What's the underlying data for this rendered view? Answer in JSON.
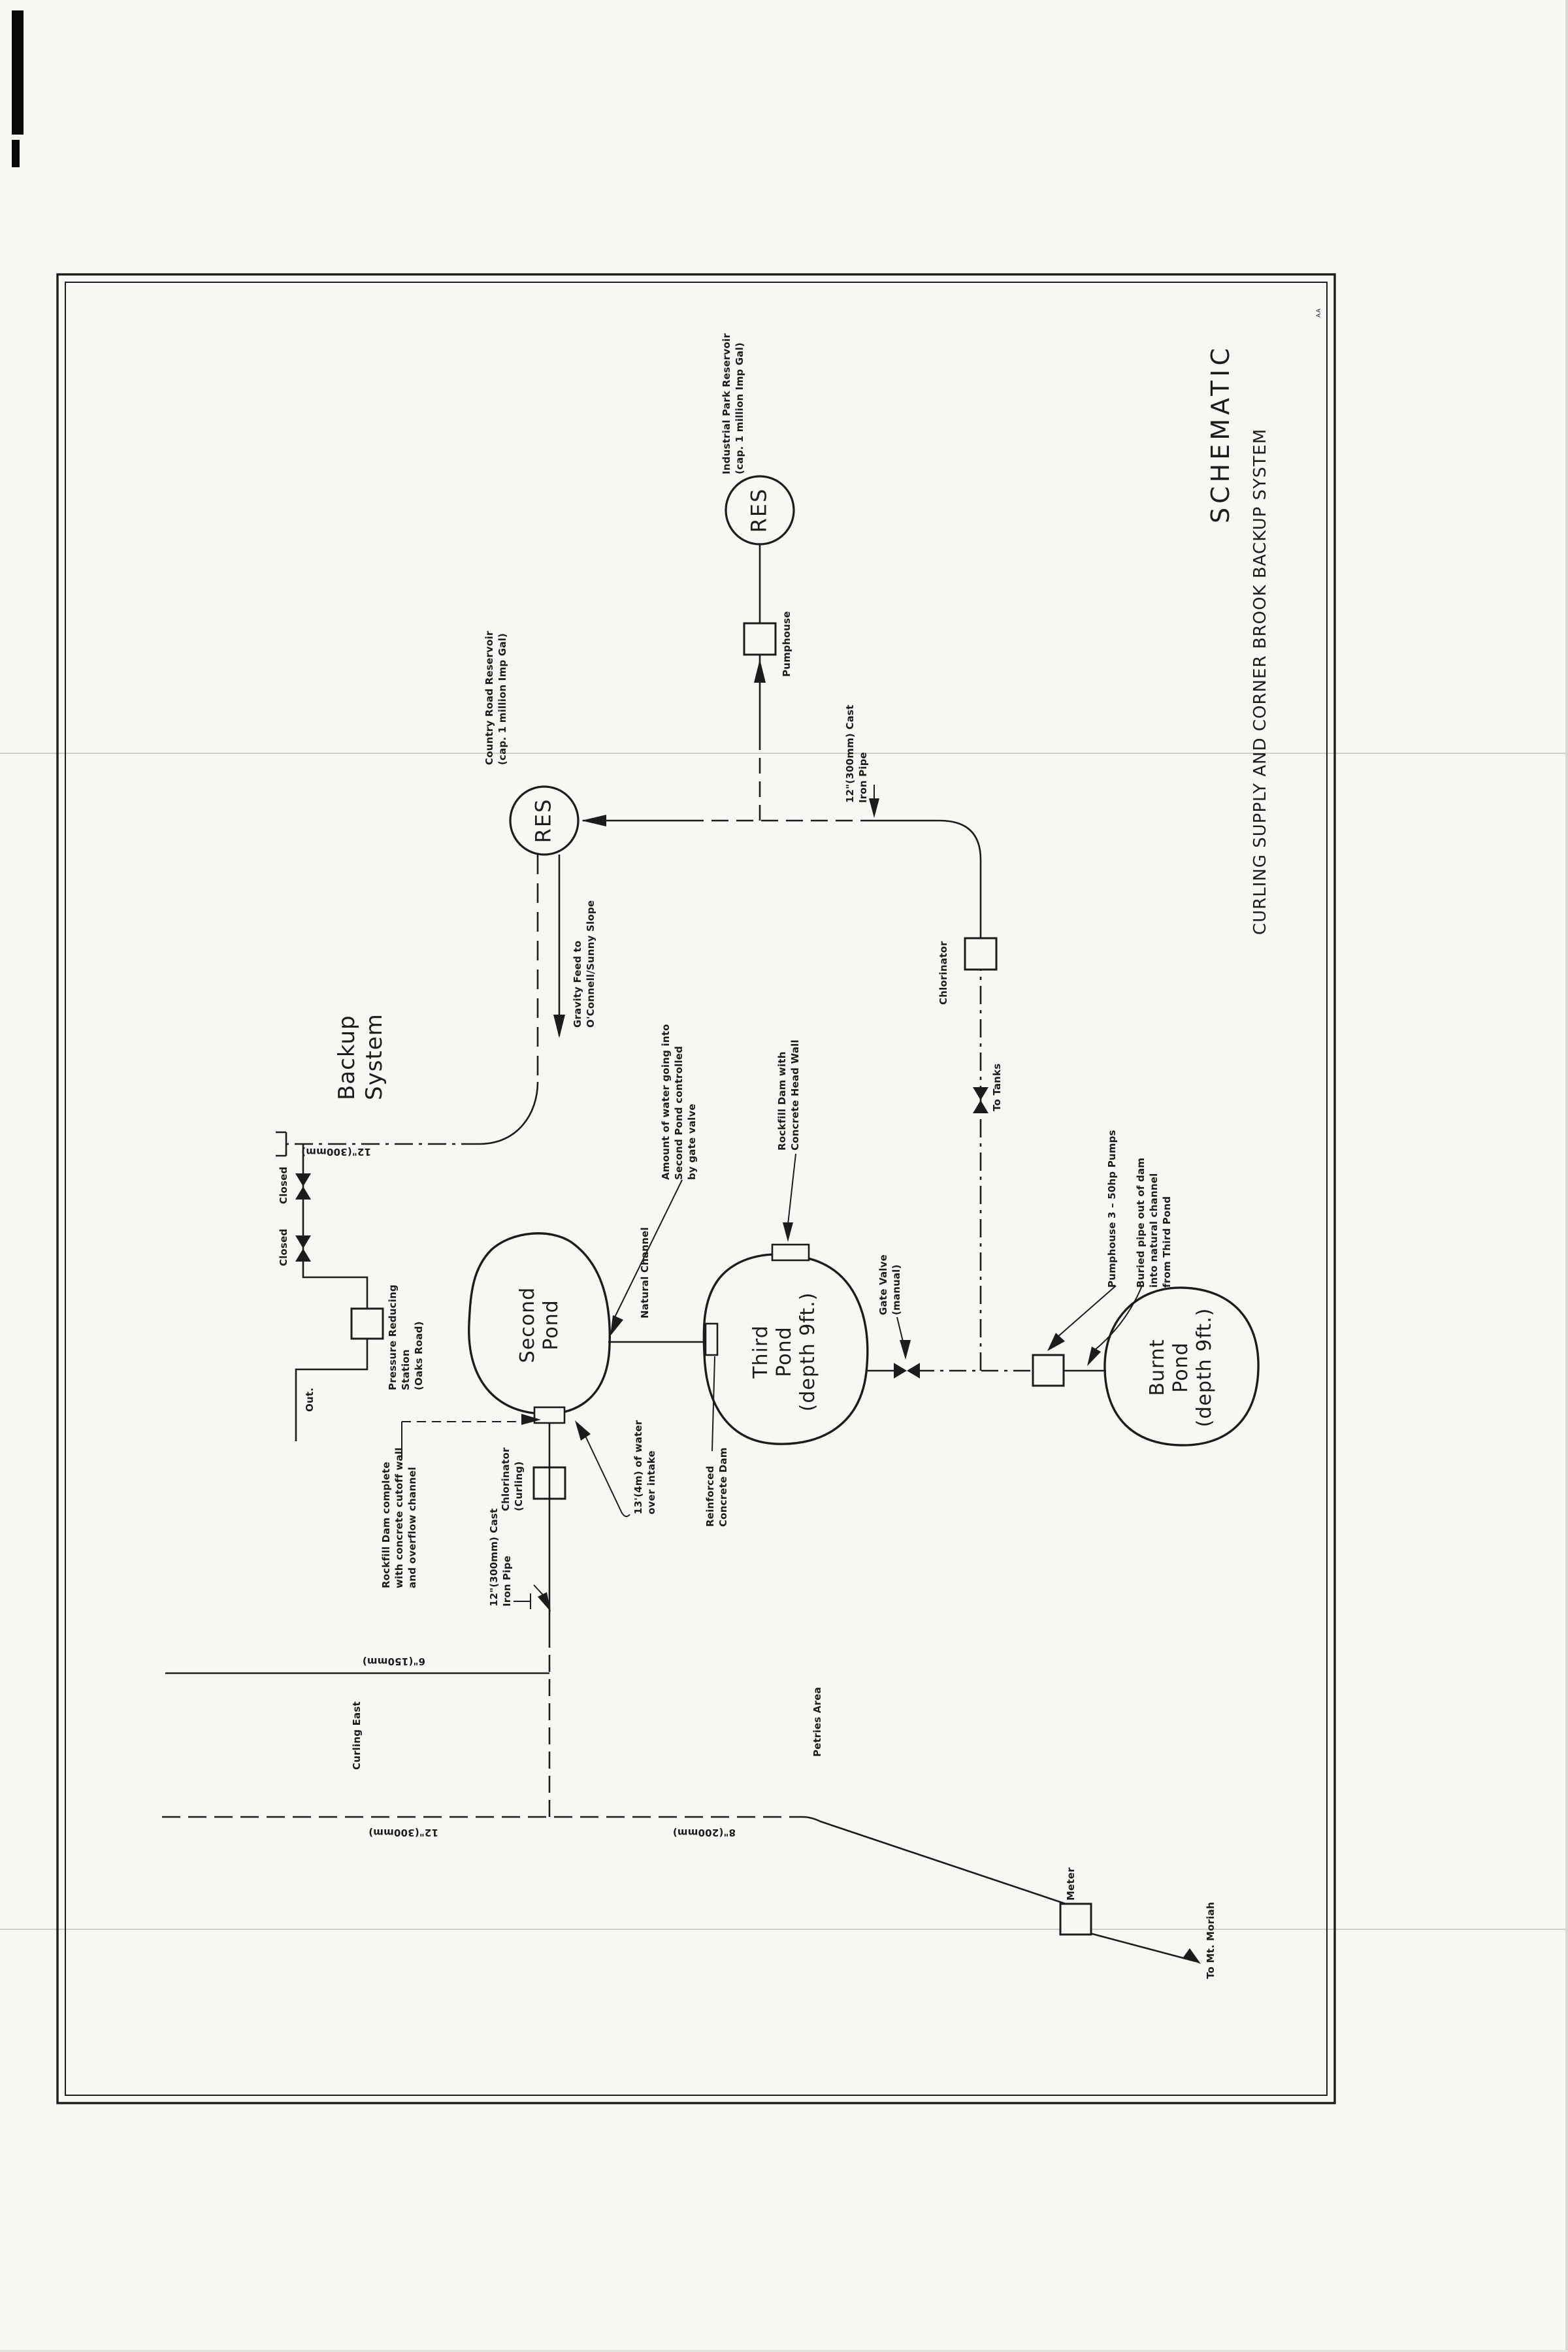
{
  "title_block": {
    "title": "SCHEMATIC",
    "subtitle": "CURLING SUPPLY AND CORNER BROOK BACKUP SYSTEM",
    "corner_mark": "AA"
  },
  "reservoirs": {
    "industrial": {
      "symbol": "RES",
      "label": "Industrial Park Reservoir\n(cap. 1 million Imp Gal)"
    },
    "country_road": {
      "symbol": "RES",
      "label": "Country Road Reservoir\n(cap. 1 million Imp Gal)"
    }
  },
  "ponds": {
    "second": "Second\nPond",
    "third": "Third\nPond\n(depth 9ft.)",
    "burnt": "Burnt\nPond\n(depth 9ft.)"
  },
  "labels": {
    "pumphouse_industrial": "Pumphouse",
    "cast_iron_pipe_right": "12\"(300mm) Cast\nIron Pipe",
    "gravity_feed": "Gravity Feed to\nO'Connell/Sunny Slope",
    "backup_system": "Backup\nSystem",
    "chlorinator_main": "Chlorinator",
    "to_tanks": "To Tanks",
    "closed_valve_1": "Closed",
    "closed_valve_2": "Closed",
    "pressure_reducing_station": "Pressure Reducing\nStation\n(Oaks Road)",
    "out": "Out.",
    "natural_channel": "Natural Channel",
    "amount_of_water": "Amount of water going into\nSecond Pond controlled\nby gate valve",
    "rockfill_head_wall": "Rockfill Dam with\nConcrete Head Wall",
    "gate_valve": "Gate Valve\n(manual)",
    "pumphouse_3": "Pumphouse 3 – 50hp Pumps",
    "buried_pipe": "Buried pipe out of dam\ninto natural channel\nfrom Third Pond",
    "chlorinator_curling": "Chlorinator\n(Curling)",
    "water_over_intake": "13'(4m) of water\nover intake",
    "reinforced_dam": "Reinforced\nConcrete Dam",
    "cast_iron_pipe_curling": "12\"(300mm) Cast\nIron Pipe",
    "rockfill_complete": "Rockfill Dam complete\nwith concrete cutoff wall\nand overflow channel",
    "curling_east": "Curling East",
    "petries_area": "Petries Area",
    "meter": "Meter",
    "to_mt_moriah": "To Mt. Moriah"
  },
  "pipe_sizes": {
    "backup_12": "12\"(300mm)",
    "main_12": "12\"(300mm)",
    "main_8": "8\"(200mm)",
    "branch_6": "6\"(150mm)"
  },
  "colors": {
    "ink": "#1c1c1c",
    "paper": "#f7f7f4"
  }
}
